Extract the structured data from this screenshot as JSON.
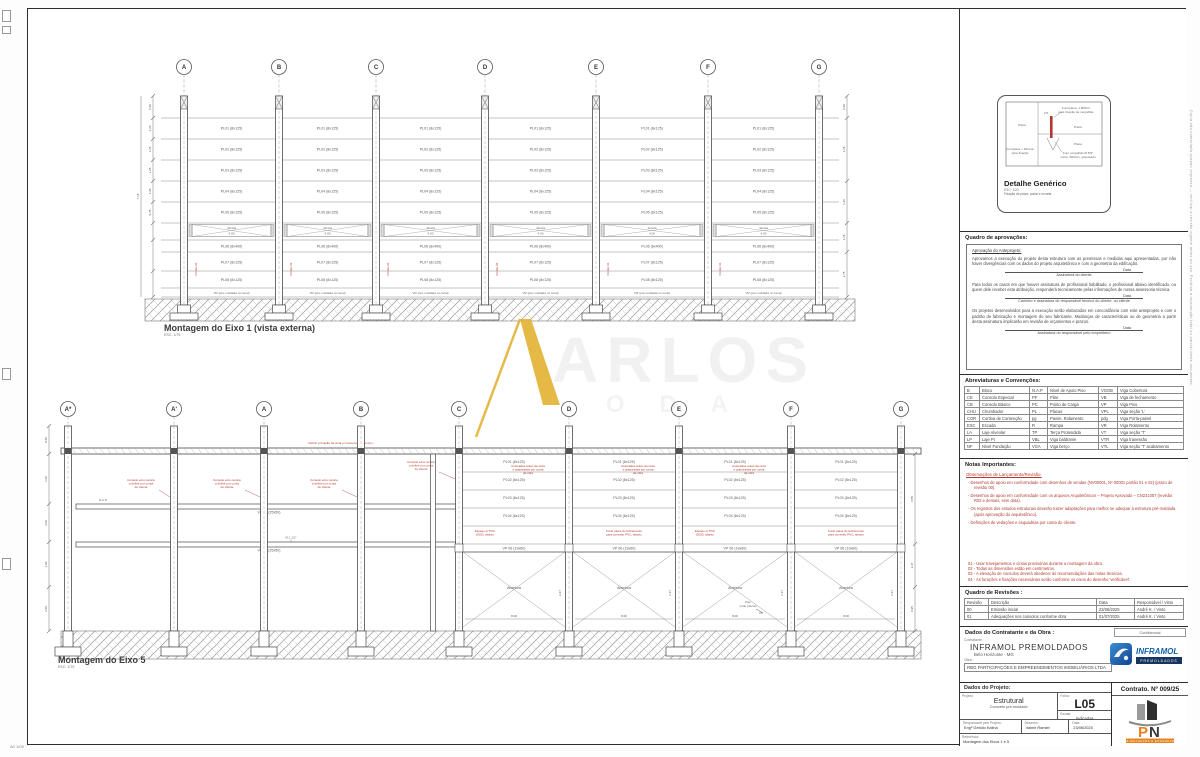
{
  "watermark": {
    "accent_letter": "A",
    "text": "ARLOS",
    "subtext": "O D A"
  },
  "sheet": {
    "corner_label": "A0 1/09",
    "edge_note": "Cópia não controlada quando impressa — verificar a revisão vigente antes do uso. Proibida a reprodução total ou parcial deste documento.",
    "inner_note": "Documento confidencial — uso exclusivo do contratante e da obra."
  },
  "drawing_top": {
    "title": "Montagem do Eixo 1 (vista externa)",
    "scale": "ESC: 1/75",
    "grid": [
      "A",
      "B",
      "C",
      "D",
      "E",
      "F",
      "G"
    ],
    "upper_rows": [
      "PL01 (8x125)",
      "PL02 (8x125)",
      "PL03 (8x125)",
      "PL04 (8x125)",
      "PL05 (8x125)"
    ],
    "window_label": "Janela",
    "window_dim": "4.00",
    "lower_rows": [
      "PL06 (8x400)",
      "PL07 (8x125)",
      "PL08 (8x125)"
    ],
    "gate_label": "Portão 01",
    "base_row": "VR (pré-moldada no local)",
    "dims_left": [
      "7.15",
      "0.40",
      "1.25",
      "1.25",
      "1.25",
      "1.25",
      "0.75"
    ],
    "dims_right": [
      "0.40",
      "1.25",
      "1.25",
      "1.25",
      "2.75"
    ]
  },
  "drawing_bottom": {
    "title": "Montagem do Eixo 5",
    "scale": "ESC: 1/75",
    "grid": [
      "A*",
      "A'",
      "A",
      "B",
      "C",
      "D",
      "E",
      "F",
      "G"
    ],
    "beam_note": "Definir a fixação da cinta p/ conta do cliente (típ.)",
    "console_note": [
      "Consolo e/ou recorte",
      "a definir por conta",
      "do cliente"
    ],
    "mezz_beam_1": "VB 01 (25x50)",
    "mezz_beam_2": "VB 02 (25x50)",
    "nap_label": "N.A.P.",
    "pipe_label": "Ø 1.1/2\"",
    "panel_rows": [
      "PL01 (8x125)",
      "PL02 (8x125)",
      "PL03 (8x125)",
      "PL04 (8x125)"
    ],
    "graute_note": [
      "Colocadas antes da cinta",
      "e grauteadas por conta",
      "da obra"
    ],
    "pvc_note": [
      "Furar placa do fechamento",
      "para conexão PVC, abaixo"
    ],
    "espaco_note": [
      "Espaço p/ PVC",
      "Ø150, abaixo"
    ],
    "beam_row": "VP 06 (19x60)",
    "abertura_label": "Abertura",
    "bay_dim": "8.00",
    "height_dim": "2.47",
    "piso_note": [
      "Piso",
      "(vide planta)"
    ],
    "dims_left": [
      "0.50",
      "1.50",
      "3.00",
      "1.00",
      "2.50"
    ],
    "dims_right": [
      "0.55",
      "2.47",
      "0.95"
    ]
  },
  "detalhe": {
    "title": "Detalhe Genérico",
    "scale": "ESC: 1/20",
    "caption": "Fixação de placa, portal e mureta",
    "lbl_placa": "Placa",
    "lbl_furo_top": [
      "Furo/placa: 1 Ø50 h/",
      "para fixação de vergalhão"
    ],
    "lbl_piso1": "Placa",
    "lbl_piso2": "Placa",
    "lbl_furo_bottom": [
      "Furo vergalhão Ø 5/8\"",
      "comp. 600mm, grauteado"
    ],
    "lbl_mureta": [
      "Furo/placa + Mureta:",
      "para fixação"
    ],
    "dim": "2.5"
  },
  "aprovacoes": {
    "title": "Quadro de aprovações:",
    "subtitle": "Aprovação do Anteprojeto:",
    "p1": "Aprovamos a execução do projeto desta estrutura com as premissas e medidas aqui apresentadas, por não haver divergências com os dados do projeto arquitetônico e com a geometria da edificação.",
    "date_label": "Data",
    "sig1": "Assinatura do cliente",
    "p2": "Para todos os casos em que houver assinatura de profissional habilitado, o profissional abaixo identificado, ou quem dele receber esta atribuição, responderá tecnicamente pelas informações de nossa assessoria técnica.",
    "sig2": "Carimbo e assinatura do responsável técnico do cliente, ou cliente",
    "p3": "Os projetos desenvolvidos para a execução serão elaborados em concordância com este anteprojeto e com o padrão de fabricação e montagem do seu fabricante. Mudanças de características ou de geometria a partir desta assinatura implicarão em revisão de orçamentos e prazos.",
    "sig3": "Assinatura do responsável pelo empreiteiro"
  },
  "abreviaturas": {
    "title": "Abreviaturas e Convenções:",
    "rows": [
      [
        "B",
        "Bloco",
        "N.A.P",
        "Nível de Apoio Piso",
        "VGOB",
        "Viga Cobertura"
      ],
      [
        "CE",
        "Consolo Especial",
        "PF",
        "Pilar",
        "VB",
        "Viga de fechamento"
      ],
      [
        "CB",
        "Consolo Básico",
        "PC",
        "Ponto de Carga",
        "VP",
        "Viga Piso"
      ],
      [
        "CHU",
        "Chumbador",
        "PL",
        "Placas",
        "VPL",
        "Viga seção 'L'"
      ],
      [
        "COR",
        "Cortina de Contenção",
        "pg",
        "Pavim. Rolamento",
        "pdg",
        "Viga Porta-painel"
      ],
      [
        "ESC",
        "Escada",
        "R",
        "Rampa",
        "VR",
        "Viga Rolamento"
      ],
      [
        "LA",
        "Laje Alveolar",
        "TP",
        "Terça Protendida",
        "VT",
        "Viga seção 'T'"
      ],
      [
        "LP",
        "Laje PI",
        "VBL",
        "Viga baldrame",
        "VTR",
        "Viga travessão"
      ],
      [
        "NF",
        "Nível Fundação",
        "VGA",
        "Viga berço",
        "VTL",
        "Viga seção 'T' acabamento"
      ]
    ]
  },
  "notas": {
    "title": "Notas Importantes:",
    "heading": "Observações de Lançamento/Revisão:",
    "bullets": [
      "Desenhos de apoio em conformidade com desenhos de vendas (NV00001, Nº 00001 portão 01 e 02) (prazo de revisão 00).",
      "Desenhos de apoio em conformidade com os arquivos Arquitetônicos – Projeto Aprovado – CN231057 (revisão R02 e demais, sem data).",
      "Os registros dos estudos estruturais deverão trazer adaptações para melhor se adequar à estrutura pré-moldada (após aprovação do arquitetônico).",
      "Definições de vedações e esquadrias por conta do cliente."
    ],
    "numbered": [
      "01 - Usar travejamentos e cintas provisórias durante a montagem da obra.",
      "02 - Todas as dimensões estão em centímetros.",
      "03 - A elevação de consolos deverá obedecer às recomendações das notas técnicas.",
      "04 - As furações e fixações necessárias serão conforme os eixos do desenho 'verificável'."
    ]
  },
  "revisoes": {
    "title": "Quadro de Revisões :",
    "headers": [
      "Revisão",
      "Descrição",
      "Data",
      "Responsável / Visto"
    ],
    "rows": [
      [
        "00",
        "Emissão inicial",
        "23/06/2025",
        "André K. / Visto"
      ],
      [
        "01",
        "Adequações nos consolos conforme obra",
        "01/07/2025",
        "André K. / Visto"
      ]
    ]
  },
  "contratante": {
    "title": "Dados do Contratante e da Obra :",
    "confidencial": "Confidencial",
    "contratante_label": "Contratante:",
    "nome": "INFRAMOL PREMOLDADOS",
    "cidade": "Belo Horizonte - MG",
    "obra_label": "Obra:",
    "obra": "RBG PARTICIPAÇÕES E EMPREENDIMENTOS IMOBILIÁRIOS LTDA",
    "local_label": "Loc. da obra:",
    "local": "Contagem - MG",
    "logo_text": "INFRAMOL",
    "logo_sub": "PREMOLDADOS"
  },
  "projeto": {
    "title": "Dados do Projeto:",
    "projeto_label": "Projeto:",
    "tipo": "Estrutural",
    "subtipo": "Concreto pré-moldado",
    "folha_label": "Folha:",
    "folha": "L05",
    "escala_label": "Escala:",
    "escala": "Indicadas",
    "resp_label": "Responsável pelo Projeto:",
    "resp": "Engº Getúlio Kalina",
    "des_label": "Desenho:",
    "des": "Valmir Ramier",
    "data_label": "Data:",
    "data": "23/06/2025",
    "ref_label": "Referência:",
    "ref": "Montagem dos Eixos 1 e 5",
    "contrato": "Contrato. Nº 009/25",
    "pn_tagline": "PRÉ-MOLDADOS E ENGENHARIA"
  }
}
